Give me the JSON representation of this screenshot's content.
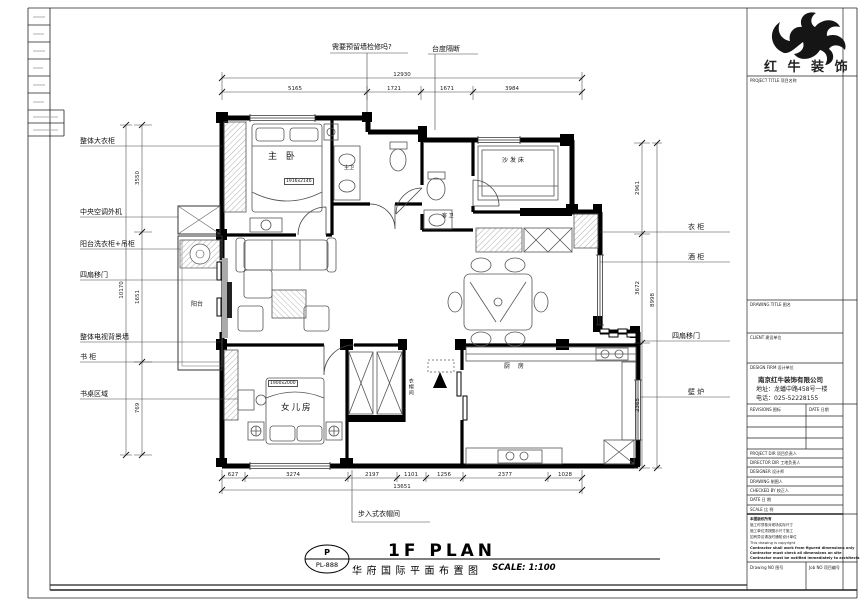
{
  "footer": {
    "code_letter": "P",
    "code": "PL-888",
    "title_en": "1F PLAN",
    "title_cn": "华府国际平面布置图",
    "scale": "SCALE: 1:100"
  },
  "rooms": {
    "master": "主 卧",
    "master_tag": "1916x2146",
    "sofa_bed": "沙发床",
    "bath_master": "主卫",
    "bath_guest": "客 卫",
    "balcony": "阳台",
    "daughter": "女儿房",
    "daughter_tag": "1900x2000",
    "kitchen": "厨 房",
    "closet": "衣帽间"
  },
  "callouts": {
    "left": [
      "整体大衣柜",
      "中央空调外机",
      "阳台洗衣柜+吊柜",
      "四扇移门",
      "整体电视背景墙",
      "书 柜",
      "书桌区域"
    ],
    "right": [
      "衣 柜",
      "酒 柜",
      "四扇移门",
      "壁 炉"
    ],
    "top": [
      "需要预留墙检修吗?",
      "台度隔断"
    ],
    "bottom": "步入式衣帽间"
  },
  "dims": {
    "top_total": "12930",
    "top": [
      "5165",
      "1721",
      "1671",
      "3984"
    ],
    "bottom": [
      "627",
      "3274",
      "2197",
      "1101",
      "1256",
      "2377",
      "1028"
    ],
    "bottom_total": "13651",
    "left": [
      "3550",
      "1651",
      "769"
    ],
    "left_total": "10170",
    "right": [
      "2961",
      "3672",
      "2365"
    ],
    "right_total": "8998"
  },
  "titleblock": {
    "company_logo_text": "红 牛 装 饰",
    "project_title_row": "PROJECT TITLE  项目名称",
    "drawing_title_label": "DRAWING TITLE  图名",
    "client_label": "CLIENT  建设单位",
    "design_firm_label": "DESIGN FIRM  设计单位",
    "company_name": "南京红牛装饰有限公司",
    "company_address": "地址：龙蟠中路458号一楼",
    "company_phone": "电话：025-52228155",
    "revisions_label": "REVISIONS  图标",
    "date_col_label": "DATE 日期",
    "staff": [
      "PROJECT DIR  项目负责人",
      "DIRECTOR DIR  工地负责人",
      "DESIGNER  设计师",
      "DRAWING  制图人",
      "CHECKED BY  校正人",
      "DATE  日 期",
      "SCALE  比 例"
    ],
    "notes": [
      "本图版权所有",
      "施工时须核对现场实际尺寸",
      "施工单位须按图示尺寸施工",
      "如有异议请及时通知设计单位",
      "This drawing is copyright",
      "Contractor shall work from figured dimensions only",
      "Contractor must check all dimensions on site",
      "Contractor must be notified immediately to architects"
    ],
    "drawing_no_label": "Drawing NO  图号",
    "job_no_label": "Job NO  项目编号"
  }
}
